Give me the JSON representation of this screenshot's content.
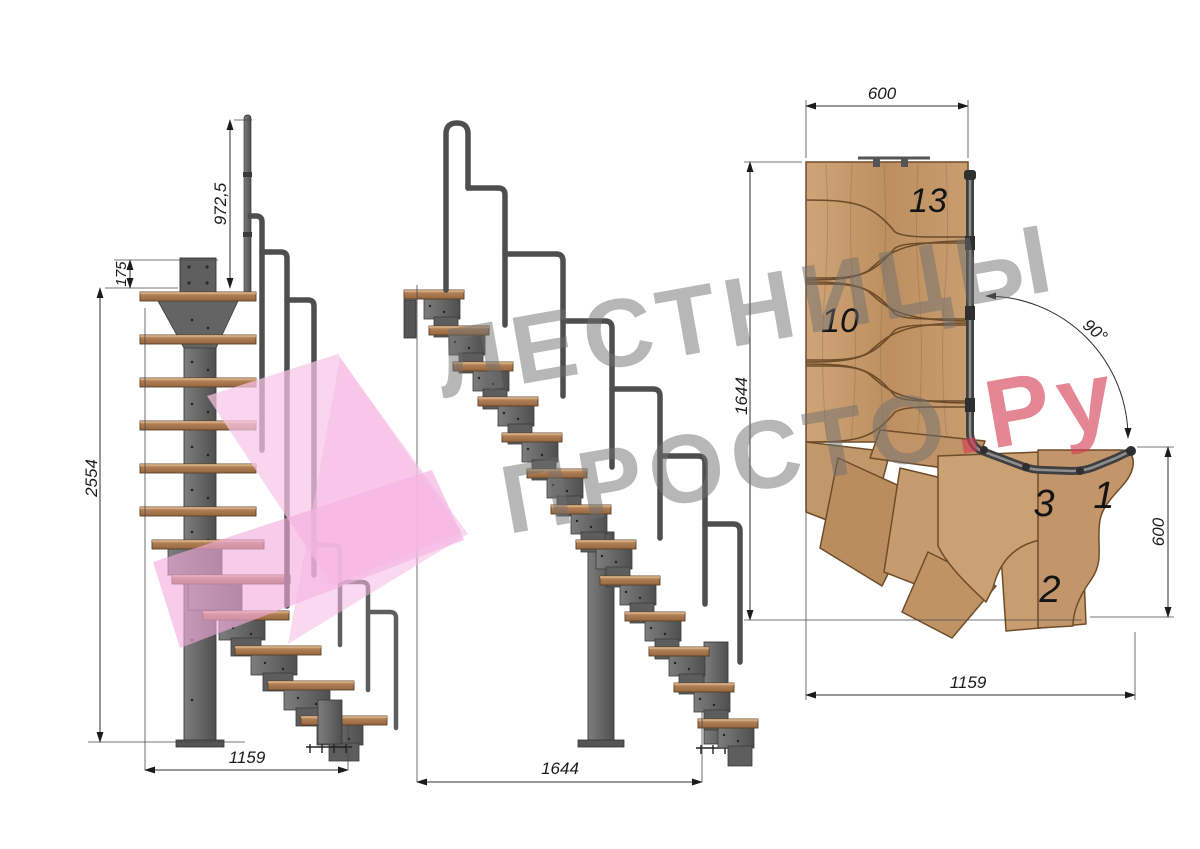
{
  "watermark": {
    "line1": "ЛЕСТНИЦЫ",
    "line2_gray": "ПРОСТО",
    "line2_red": ".Ру",
    "gray_color": "#6f6f6f",
    "red_color": "#d43c52",
    "pink_color": "#f3abdf"
  },
  "side_view": {
    "handrail_height": "972,5",
    "plate_offset": "175",
    "total_height": "2554",
    "footprint": "1159"
  },
  "front_view": {
    "footprint": "1644"
  },
  "plan_view": {
    "width_top": "600",
    "length_left": "1644",
    "turn_angle": "90°",
    "width_right": "600",
    "length_bottom": "1159",
    "step_numbers": {
      "step_13": "13",
      "step_10": "10",
      "step_3": "3",
      "step_1": "1",
      "step_2": "2"
    }
  },
  "colors": {
    "wood_plan": "#c49a6c",
    "wood_tread_side": "#ad7c52",
    "metal": "#6a6a6a",
    "metal_dark": "#4a4a4a",
    "dimension": "#1b1b1b"
  }
}
